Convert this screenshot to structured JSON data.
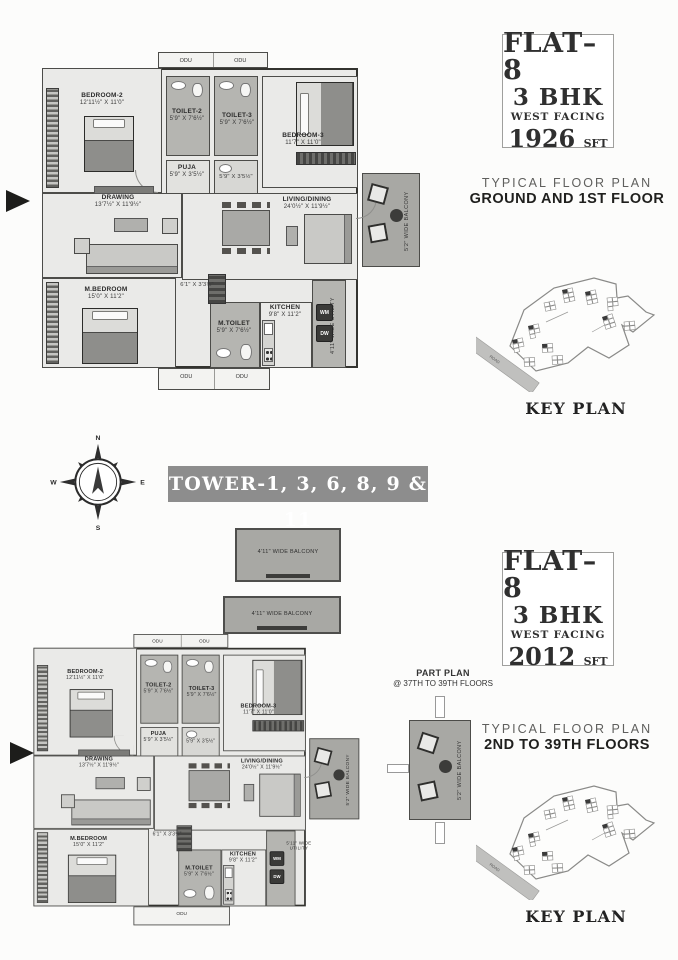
{
  "info1": {
    "flat": "FLAT–8",
    "bhk": "3 BHK",
    "facing": "WEST FACING",
    "area": "1926",
    "unit": "SFT"
  },
  "caption1": {
    "line1": "TYPICAL FLOOR PLAN",
    "line2": "GROUND AND 1ST FLOOR"
  },
  "info2": {
    "flat": "FLAT–8",
    "bhk": "3 BHK",
    "facing": "WEST FACING",
    "area": "2012",
    "unit": "SFT"
  },
  "caption2": {
    "line1": "TYPICAL FLOOR PLAN",
    "line2": "2ND TO 39TH FLOORS"
  },
  "banner": {
    "text": "TOWER-1, 3, 6, 8, 9 & 11"
  },
  "compass": {
    "n": "N",
    "e": "E",
    "s": "S",
    "w": "W"
  },
  "keyplan": {
    "label": "KEY PLAN",
    "road": "ROAD"
  },
  "partplan": {
    "line1": "PART PLAN",
    "line2": "@ 37TH TO 39TH FLOORS",
    "balcony": "5'2\" WIDE BALCONY"
  },
  "colors": {
    "banner_bg": "#8d8d8d",
    "wall": "#33332f",
    "room_gray": "#b5b5b1",
    "balcony_gray": "#a8a8a4"
  },
  "plan1": {
    "bedroom2": {
      "name": "BEDROOM-2",
      "dims": "12'11½\" X 11'0\""
    },
    "toilet2": {
      "name": "TOILET-2",
      "dims": "5'9\" X 7'6½\""
    },
    "toilet3": {
      "name": "TOILET-3",
      "dims": "5'9\" X 7'6½\""
    },
    "puja": {
      "name": "PUJA",
      "dims": "5'9\" X 3'5½\""
    },
    "wash": {
      "dims": "5'9\" X 3'5½\""
    },
    "bedroom3": {
      "name": "BEDROOM-3",
      "dims": "11'7\" X 11'0\""
    },
    "drawing": {
      "name": "DRAWING",
      "dims": "13'7½\" X 11'9½\""
    },
    "living": {
      "name": "LIVING/DINING",
      "dims": "24'0½\" X 11'9½\""
    },
    "mbedroom": {
      "name": "M.BEDROOM",
      "dims": "15'0\" X 11'2\""
    },
    "passage": {
      "dims": "6'1\" X 3'3½\""
    },
    "mtoilet": {
      "name": "M.TOILET",
      "dims": "5'9\" X 7'6½\""
    },
    "kitchen": {
      "name": "KITCHEN",
      "dims": "9'8\" X 11'2\""
    },
    "utility": {
      "label": "4'11\" WIDE UTILITY"
    },
    "balcony": {
      "label": "5'2\" WIDE BALCONY"
    },
    "odu_t1": "ODU",
    "odu_t2": "ODU",
    "odu_b1": "ODU",
    "odu_b2": "ODU",
    "wm": "WM",
    "dw": "DW"
  },
  "plan2": {
    "top_balcony1": {
      "label": "4'11\" WIDE BALCONY"
    },
    "top_balcony2": {
      "label": "4'11\" WIDE BALCONY"
    },
    "bedroom2": {
      "name": "BEDROOM-2",
      "dims": "12'11½\" X 11'0\""
    },
    "toilet2": {
      "name": "TOILET-2",
      "dims": "5'9\" X 7'6½\""
    },
    "toilet3": {
      "name": "TOILET-3",
      "dims": "5'9\" X 7'6½\""
    },
    "puja": {
      "name": "PUJA",
      "dims": "5'9\" X 3'5½\""
    },
    "wash": {
      "dims": "5'9\" X 3'5½\""
    },
    "bedroom3": {
      "name": "BEDROOM-3",
      "dims": "11'7\" X 11'0\""
    },
    "drawing": {
      "name": "DRAWING",
      "dims": "13'7½\" X 11'9½\""
    },
    "living": {
      "name": "LIVING/DINING",
      "dims": "24'0½\" X 11'9½\""
    },
    "mbedroom": {
      "name": "M.BEDROOM",
      "dims": "15'0\" X 11'2\""
    },
    "passage": {
      "dims": "6'1\" X 3'3½\""
    },
    "mtoilet": {
      "name": "M.TOILET",
      "dims": "5'9\" X 7'6½\""
    },
    "kitchen": {
      "name": "KITCHEN",
      "dims": "9'8\" X 11'2\""
    },
    "utility": {
      "label": "5'11\" WIDE UTILITY"
    },
    "balcony": {
      "label": "5'2\" WIDE BALCONY"
    },
    "odu_t1": "ODU",
    "odu_t2": "ODU",
    "odu_b1": "ODU",
    "odu_b2": "",
    "wm": "WM",
    "dw": "DW"
  }
}
